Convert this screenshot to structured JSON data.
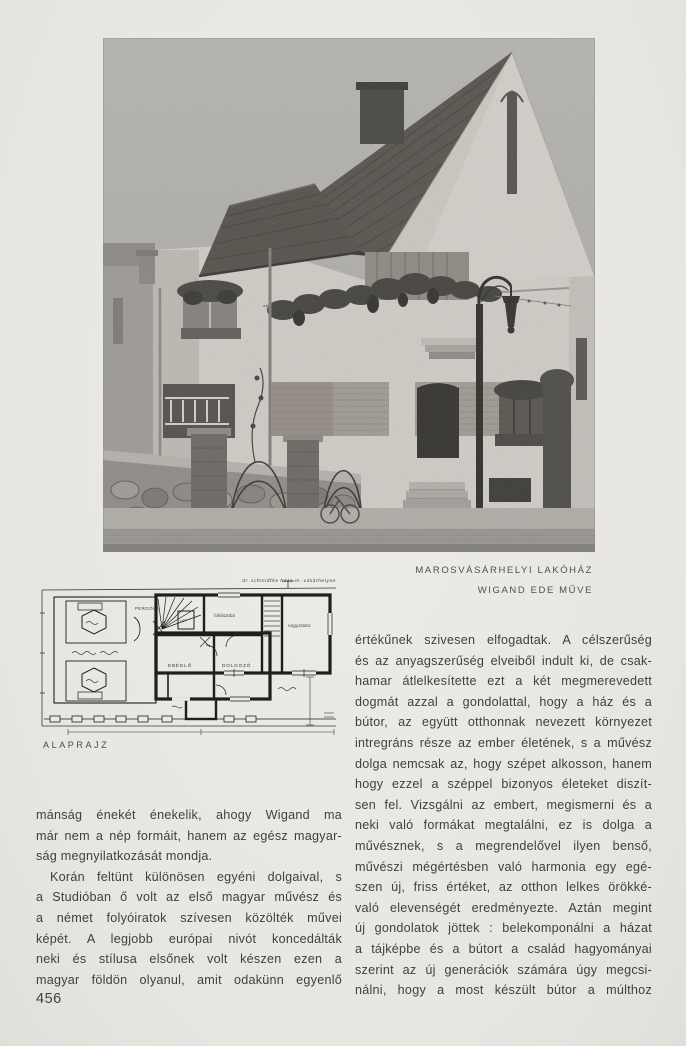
{
  "page": {
    "number": "456"
  },
  "caption": {
    "line1": "MAROSVÁSÁRHELYI LAKÓHÁZ",
    "line2": "WIGAND EDE MŰVE"
  },
  "plan": {
    "label": "ALAPRAJZ",
    "handwritten_title": "dr. schmidtke háza m.-vásárhelyen",
    "rooms": {
      "pergola": "PERGOLA",
      "lift": "LIFT",
      "ebedlo": "EBÉDLŐ",
      "dolgozo": "DOLGOZÓ",
      "haloszoba": "hálószoba",
      "nagyszoba": "nagyszoba"
    }
  },
  "colors": {
    "paper": "#eae9e5",
    "ink": "#403f3a",
    "photo_sky": "#b7b5b0",
    "photo_roof": "#55524c"
  },
  "columns": {
    "left": {
      "lines": [
        "mánság énekét énekelik, ahogy Wigand ma",
        "már nem a nép formáit, hanem az egész magyar-",
        "ság megnyilatkozását mondja.",
        "Korán feltünt különösen egyéni dolgaival, s",
        "a Studióban ő volt az első magyar művész és",
        "a német folyóiratok szívesen közölték művei",
        "képét. A legjobb európai nivót koncedálták",
        "neki és stílusa elsőnek volt készen ezen a",
        "magyar földön olyanul, amit odakünn egyenlő"
      ]
    },
    "right": {
      "lines": [
        "értékűnek szivesen elfogadtak. A célszerűség",
        "és az anyagszerűség elveiből indult ki, de csak-",
        "hamar átlelkesítette ezt a két megmerevedett",
        "dogmát azzal a gondolattal, hogy a ház és a",
        "bútor, az együtt otthonnak nevezett környezet",
        "intregráns része az ember életének, s a művész",
        "dolga nemcsak az, hogy szépet alkosson, hanem",
        "hogy ezzel a széppel bizonyos életeket diszít-",
        "sen fel. Vizsgálni az embert, megismerni és a",
        "neki való formákat megtalálni, ez is dolga a",
        "művésznek, s a megrendelővel ilyen benső,",
        "művészi mégértésben való harmonia egy egé-",
        "szen új, friss értéket, az otthon lelkes örökké-",
        "való elevenségét eredményezte. Aztán megint",
        "új gondolatok jöttek : belekomponálni a házat",
        "a tájképbe és a bútort a család hagyományai",
        "szerint az új generációk számára úgy megcsi-",
        "nálni, hogy a most készült bútor a múlthoz"
      ]
    }
  }
}
